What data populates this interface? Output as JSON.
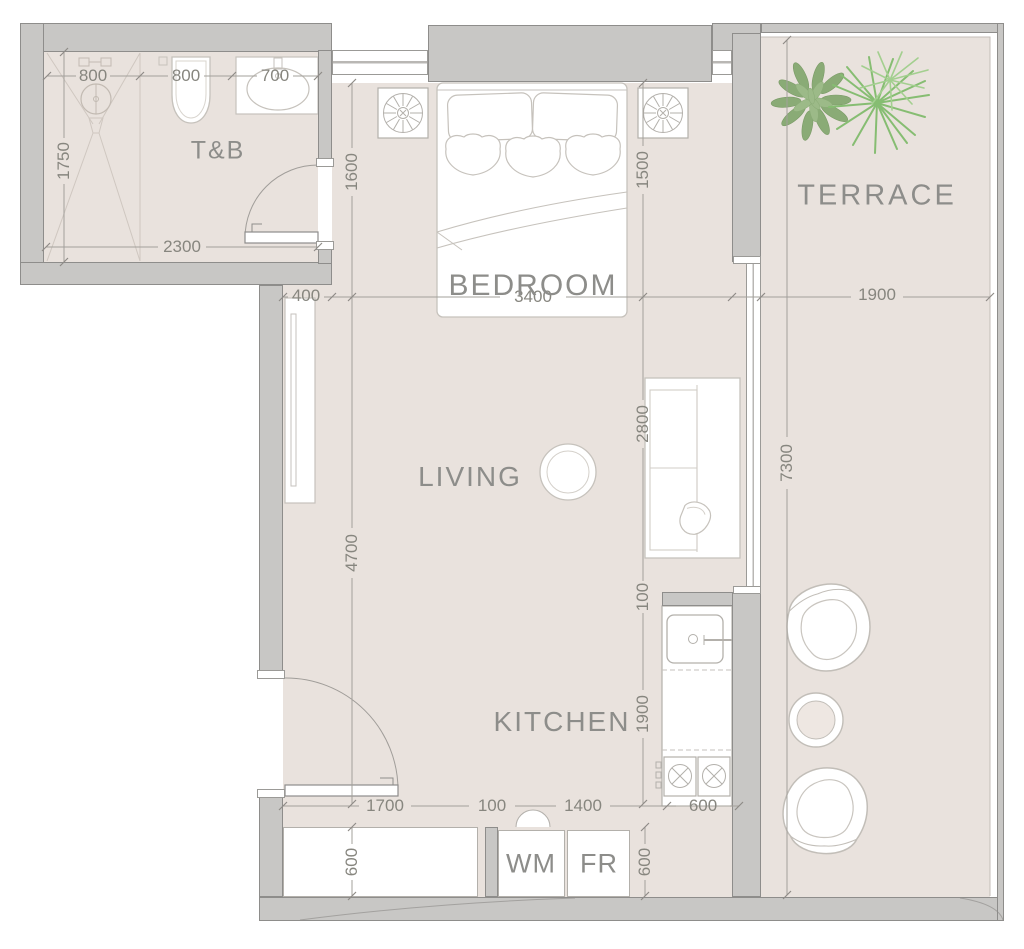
{
  "title": "Studio apartment floor plan",
  "colors": {
    "floor": "#e9e2dd",
    "wall_fill": "#c8c7c5",
    "wall_stroke": "#8e8d8b",
    "label_text": "#8d8d8a",
    "dimension_text": "#87867f",
    "furniture_stroke": "#bdb9b3",
    "plant_leaf_green": "#8aab76",
    "plant_palm_green": "#86bd72"
  },
  "rooms": {
    "tb": "T&B",
    "bedroom": "BEDROOM",
    "terrace": "TERRACE",
    "living": "LIVING",
    "kitchen": "KITCHEN",
    "washing_machine": "WM",
    "fridge": "FR"
  },
  "dimensions": {
    "tb_shower_width": "800",
    "tb_toilet_width": "800",
    "tb_sink_width": "700",
    "tb_depth": "1750",
    "tb_width": "2300",
    "bedroom_left_height": "1600",
    "bedroom_right_height": "1500",
    "living_wall_offset": "400",
    "bedroom_width": "3400",
    "terrace_width": "1900",
    "living_glass_height": "2800",
    "terrace_height": "7300",
    "living_height": "4700",
    "kitchen_stub": "100",
    "kitchen_counter_length": "1900",
    "entry_width": "1700",
    "entry_gap": "100",
    "kitchen_width": "1400",
    "kitchen_counter_depth": "600",
    "wardrobe_depth": "600",
    "appliance_depth": "600"
  }
}
